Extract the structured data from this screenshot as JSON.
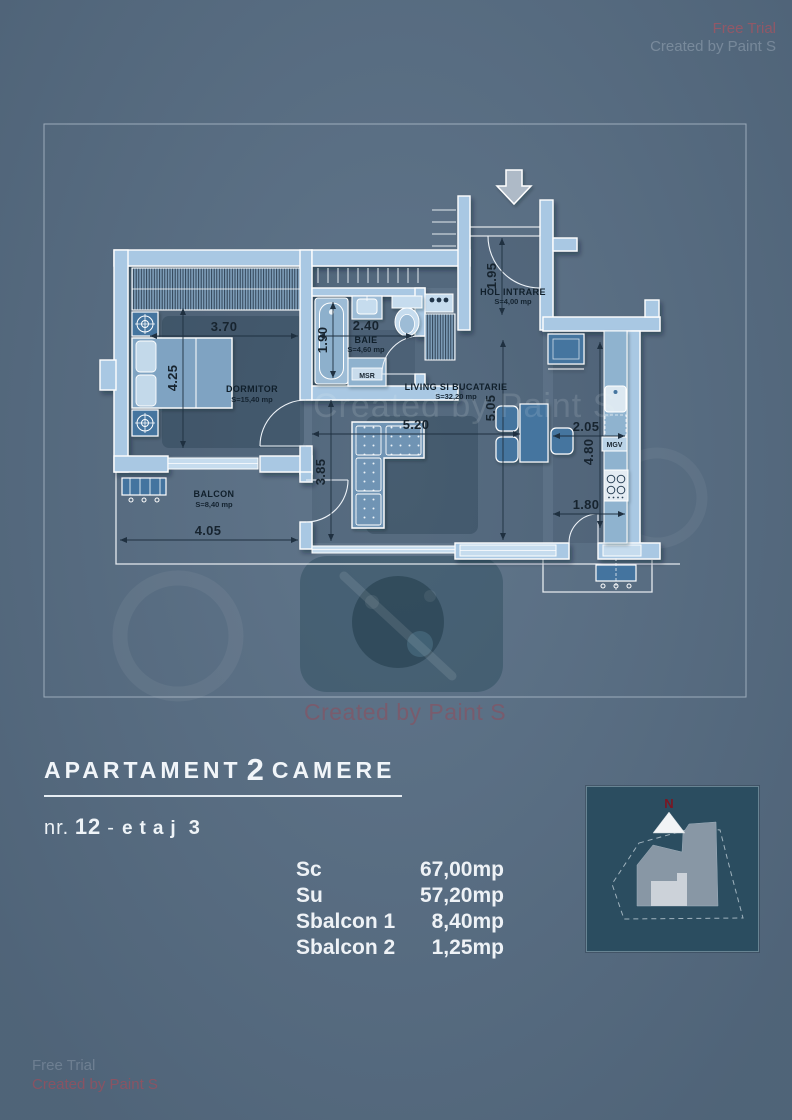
{
  "watermarks": {
    "free_trial": "Free Trial",
    "created_by": "Created by Paint S"
  },
  "plan": {
    "rooms": {
      "dormitor_name": "DORMITOR",
      "dormitor_area": "S=15,40 mp",
      "baie_name": "BAIE",
      "baie_area": "S=4,60 mp",
      "hol_name": "HOL INTRARE",
      "hol_area": "S=4,00 mp",
      "living_name": "LIVING SI BUCATARIE",
      "living_area": "S=32,20 mp",
      "balcon_name": "BALCON",
      "balcon_area": "S=8,40 mp",
      "msr": "MSR",
      "mgv": "MGV"
    },
    "dims": {
      "bedroom_w": "3.70",
      "bedroom_h": "4.25",
      "bath_w": "2.40",
      "bath_h": "1.90",
      "hall_h": "1.95",
      "living_w": "5.20",
      "living_h": "3.85",
      "living_h2": "5.05",
      "kitchen_w": "2.05",
      "kitchen_h": "4.80",
      "kitchen_door_w": "1.80",
      "balcony_w": "4.05"
    }
  },
  "info": {
    "title_left": "APARTAMENT",
    "title_num": "2",
    "title_right": "CAMERE",
    "nr_label": "nr.",
    "nr_value": "12",
    "dash": "-",
    "etaj_label": "etaj",
    "etaj_value": "3",
    "areas": [
      {
        "label": "Sc",
        "value": "67,00mp"
      },
      {
        "label": "Su",
        "value": "57,20mp"
      },
      {
        "label": "Sbalcon 1",
        "value": "8,40mp"
      },
      {
        "label": "Sbalcon 2",
        "value": "1,25mp"
      }
    ]
  },
  "minimap": {
    "north": "N"
  },
  "colors": {
    "background": "#5b7187",
    "wall": "#a9c8e3",
    "furniture_dark": "#44749f",
    "map_background": "#2b4d60",
    "north_red": "#7b1622",
    "watermark_red": "#c8414b",
    "text_white": "#eef2f6",
    "plan_text_dark": "#17242f"
  }
}
